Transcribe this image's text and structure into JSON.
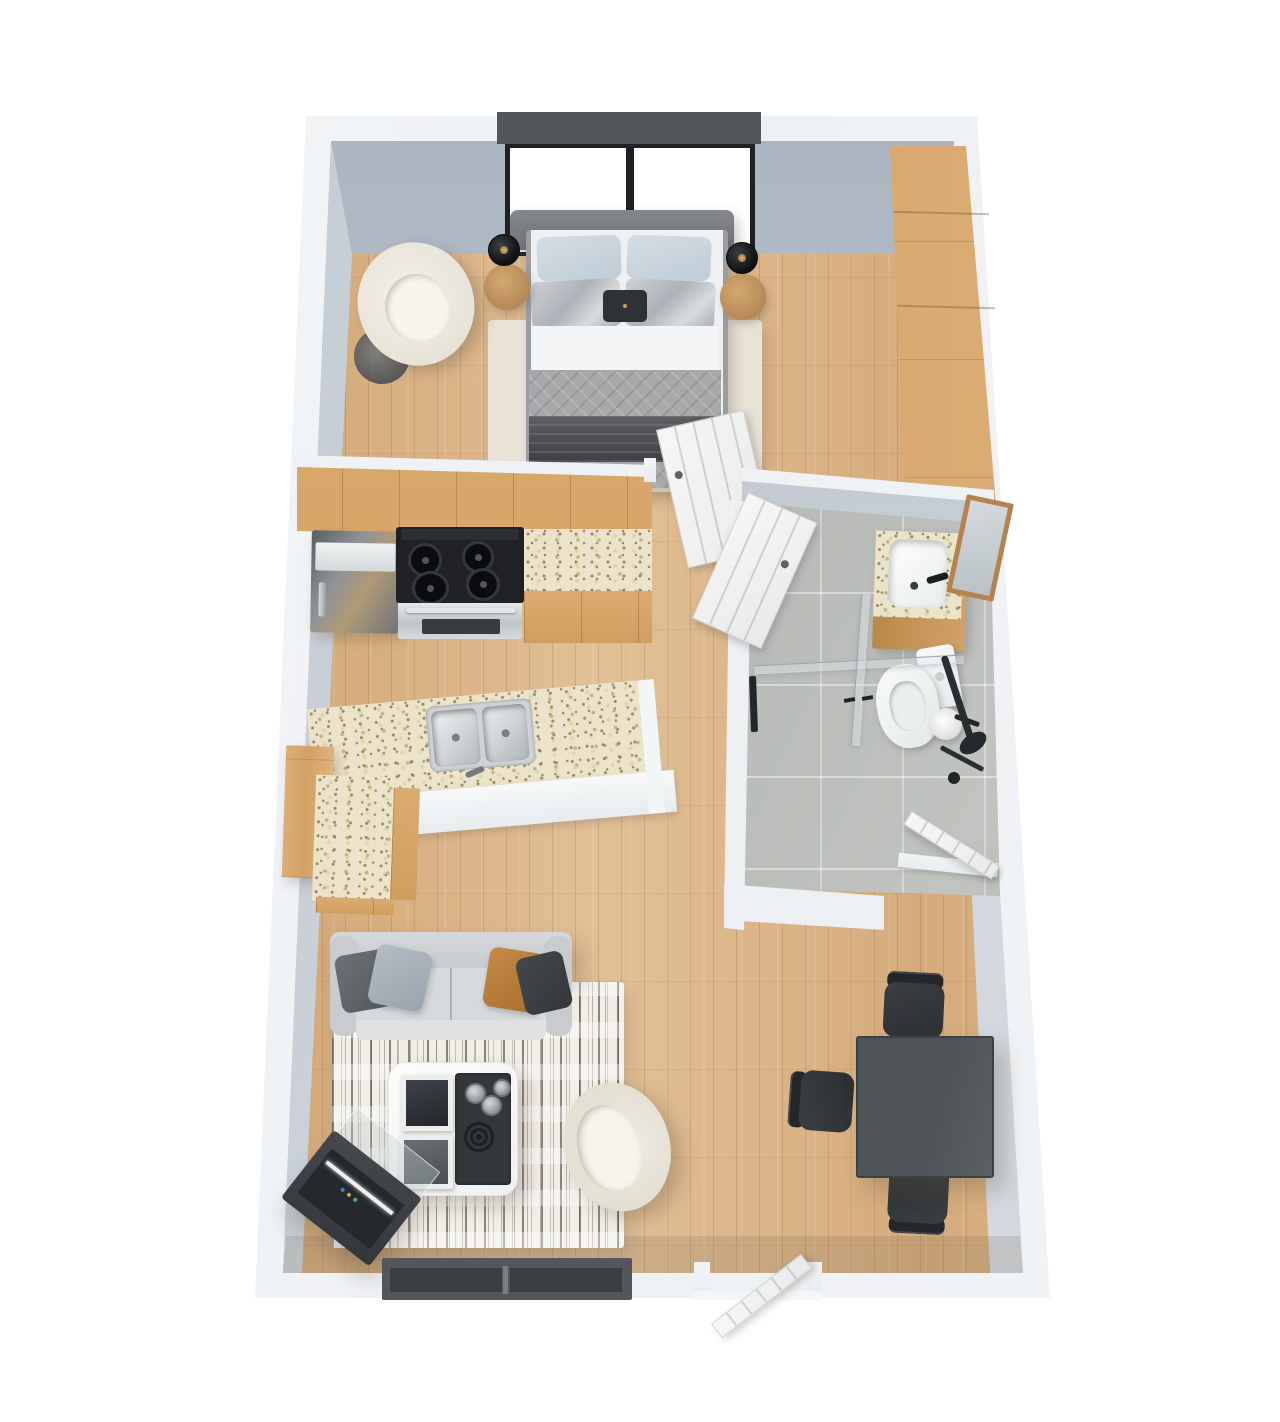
{
  "scene": {
    "description": "3D top-down render of a studio apartment floor plan",
    "background": "#ffffff",
    "visible_text": "none"
  },
  "palette": {
    "canvas": "#ffffff",
    "wall_outer": "#f1f3f5",
    "wall_face": "#b7c0ca",
    "floor_wood": "#d9b284",
    "cabinet_wood": "#d4a369",
    "wardrobe_wood": "#d8ab74",
    "granite": "#ece4ca",
    "bath_tile": "#b9bcb8",
    "door_white": "#f3f4f3",
    "sofa_gray": "#ced1d3",
    "bed_quilt": "#a6a8aa",
    "blanket_dark": "#4a4c4f",
    "pillow_blue": "#ccd7e0",
    "pillow_silver": "#bdc1c6",
    "pillow_caramel": "#b9803f",
    "pillow_charcoal": "#3a3e42",
    "appliance_black": "#202225",
    "steel": "#c2c6ca",
    "fixture_white": "#f5f7f7",
    "rug_bedroom": "#e8e2d7",
    "rug_living": "#f0ede6",
    "dining_table": "#4e5357",
    "chair_black": "#303437",
    "window_frame_dark": "#53575c",
    "window_mullion": "#1e2023",
    "lamp_black": "#17181a",
    "mirror_wood": "#b5834f",
    "fireplace_dark": "#3a3e42"
  },
  "rooms": [
    {
      "name": "bedroom",
      "floor": "wood",
      "furniture": [
        "double-bed",
        "headboard",
        "bed-rug",
        "boucle-armchair",
        "glass-side-table",
        "nightstand-left",
        "nightstand-right",
        "table-lamp-left",
        "table-lamp-right",
        "wardrobe",
        "picture-window"
      ]
    },
    {
      "name": "kitchen",
      "floor": "wood",
      "furniture": [
        "upper-cabinets",
        "refrigerator",
        "gas-cooktop-stove",
        "oven",
        "granite-counter",
        "island-double-sink",
        "white-waterfall-panel",
        "peninsula-counter",
        "tall-cabinet"
      ]
    },
    {
      "name": "bathroom",
      "floor": "gray-tile",
      "furniture": [
        "wood-vanity-sink",
        "black-faucet",
        "wood-framed-mirror",
        "toilet",
        "toilet-paper-holder",
        "walk-in-shower-glass",
        "shower-fixture",
        "towel-bar"
      ]
    },
    {
      "name": "living-room",
      "floor": "wood",
      "furniture": [
        "three-seat-sofa",
        "throw-pillows",
        "distressed-area-rug",
        "white-coffee-table",
        "art-books",
        "serving-tray",
        "boucle-tub-chair",
        "media-fireplace-console",
        "low-window"
      ]
    },
    {
      "name": "dining-nook",
      "floor": "wood",
      "furniture": [
        "square-dark-table",
        "dining-chair-north",
        "dining-chair-west",
        "dining-chair-south"
      ]
    },
    {
      "name": "hallway",
      "floor": "wood",
      "furniture": [
        "bedroom-door-open",
        "bathroom-door-open",
        "bathroom-rear-door-open",
        "entry-door-open"
      ]
    }
  ]
}
